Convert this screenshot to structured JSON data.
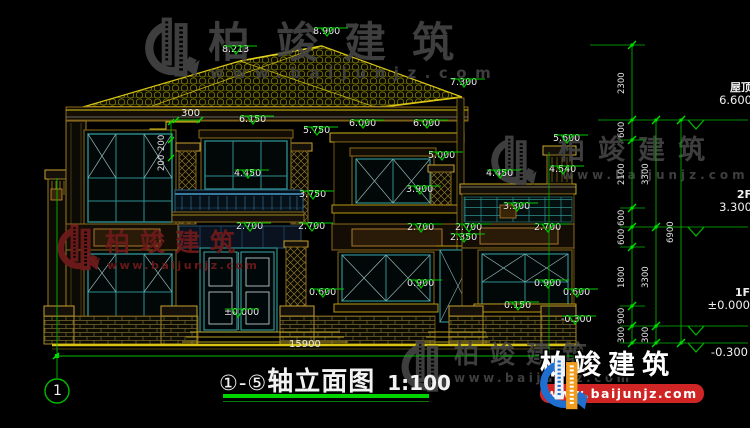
{
  "drawing": {
    "title": {
      "axis_start": "①",
      "dash": "-",
      "axis_end": "⑤",
      "name": "轴立面图",
      "scale": "1:100"
    },
    "axis_bubble_label": "1",
    "bottom_overall_dim": "15900",
    "levels_right": [
      {
        "label": "屋顶",
        "value": "6.600",
        "line_y": 120,
        "tx": 694,
        "ty": 82
      },
      {
        "label": "2F",
        "value": "3.300",
        "line_y": 227,
        "tx": 694,
        "ty": 189
      },
      {
        "label": "1F",
        "value": "±0.000",
        "line_y": 326,
        "tx": 692,
        "ty": 287
      },
      {
        "label": "",
        "value": "-0.300",
        "line_y": 343,
        "tx": 690,
        "ty": 346
      }
    ],
    "dim_chains": [
      {
        "x": 632,
        "ticks": [
          45,
          120,
          140,
          208,
          227,
          247,
          306,
          326,
          343
        ],
        "labels": [
          "2300",
          "600",
          "2100",
          "600",
          "600",
          "1800",
          "900",
          "300"
        ]
      },
      {
        "x": 656,
        "ticks": [
          120,
          227,
          326,
          343
        ],
        "labels": [
          "3300",
          "3300",
          "300"
        ]
      },
      {
        "x": 681,
        "ticks": [
          120,
          343
        ],
        "labels": [
          "6900"
        ]
      }
    ],
    "spot_levels": [
      {
        "text": "8.900",
        "x": 313,
        "y": 27
      },
      {
        "text": "8.213",
        "x": 222,
        "y": 45
      },
      {
        "text": "7.300",
        "x": 450,
        "y": 78
      },
      {
        "text": "6.150",
        "x": 239,
        "y": 115
      },
      {
        "text": "6.000",
        "x": 349,
        "y": 119
      },
      {
        "text": "6.000",
        "x": 413,
        "y": 119
      },
      {
        "text": "5.750",
        "x": 303,
        "y": 126
      },
      {
        "text": "5.600",
        "x": 553,
        "y": 134
      },
      {
        "text": "5.000",
        "x": 428,
        "y": 151
      },
      {
        "text": "4.540",
        "x": 549,
        "y": 165
      },
      {
        "text": "4.450",
        "x": 234,
        "y": 169
      },
      {
        "text": "4.450",
        "x": 486,
        "y": 169
      },
      {
        "text": "3.900",
        "x": 406,
        "y": 185
      },
      {
        "text": "3.750",
        "x": 299,
        "y": 190
      },
      {
        "text": "3.300",
        "x": 503,
        "y": 202
      },
      {
        "text": "2.700",
        "x": 236,
        "y": 222
      },
      {
        "text": "2.700",
        "x": 298,
        "y": 222
      },
      {
        "text": "2.700",
        "x": 407,
        "y": 223
      },
      {
        "text": "2.700",
        "x": 455,
        "y": 223
      },
      {
        "text": "2.700",
        "x": 534,
        "y": 223
      },
      {
        "text": "2.350",
        "x": 450,
        "y": 233
      },
      {
        "text": "0.900",
        "x": 407,
        "y": 279
      },
      {
        "text": "0.900",
        "x": 534,
        "y": 279
      },
      {
        "text": "0.600",
        "x": 309,
        "y": 288
      },
      {
        "text": "0.600",
        "x": 563,
        "y": 288
      },
      {
        "text": "0.150",
        "x": 504,
        "y": 301
      },
      {
        "text": "±0.000",
        "x": 224,
        "y": 308
      },
      {
        "text": "-0.300",
        "x": 561,
        "y": 315
      }
    ],
    "linear_dims": [
      {
        "text": "300",
        "x": 181,
        "y": 109,
        "rot": 0
      },
      {
        "text": "200",
        "x": 158,
        "y": 120,
        "rot": 90
      },
      {
        "text": "200",
        "x": 158,
        "y": 140,
        "rot": 90
      },
      {
        "text": "15900",
        "x": 289,
        "y": 340,
        "rot": 0
      }
    ]
  },
  "watermarks": {
    "brand": "柏竣建筑",
    "url": "www.baijunjz.com",
    "instances": [
      {
        "style": "gray",
        "x": 138,
        "y": 12,
        "icon_w": 64,
        "icon_h": 72,
        "brand_dx": 70,
        "brand_dy": 10,
        "brand_size": 42,
        "brand_sp": 26,
        "url_dx": 72,
        "url_dy": 54,
        "url_size": 15,
        "url_sp": 8.5
      },
      {
        "style": "red",
        "x": 53,
        "y": 220,
        "icon_w": 48,
        "icon_h": 56,
        "brand_dx": 52,
        "brand_dy": 10,
        "brand_size": 25,
        "brand_sp": 10,
        "url_dx": 54,
        "url_dy": 40,
        "url_size": 11,
        "url_sp": 2.5
      },
      {
        "style": "gray",
        "x": 486,
        "y": 131,
        "icon_w": 52,
        "icon_h": 60,
        "brand_dx": 72,
        "brand_dy": 6,
        "brand_size": 27,
        "brand_sp": 13,
        "url_dx": 76,
        "url_dy": 38,
        "url_size": 12,
        "url_sp": 4
      },
      {
        "style": "gray",
        "x": 396,
        "y": 336,
        "icon_w": 54,
        "icon_h": 62,
        "brand_dx": 58,
        "brand_dy": 6,
        "brand_size": 25,
        "brand_sp": 11,
        "url_dx": 58,
        "url_dy": 36,
        "url_size": 12,
        "url_sp": 3.5
      }
    ],
    "logo_brand": "柏竣建筑",
    "logo_url": "www.baijunjz.com"
  }
}
